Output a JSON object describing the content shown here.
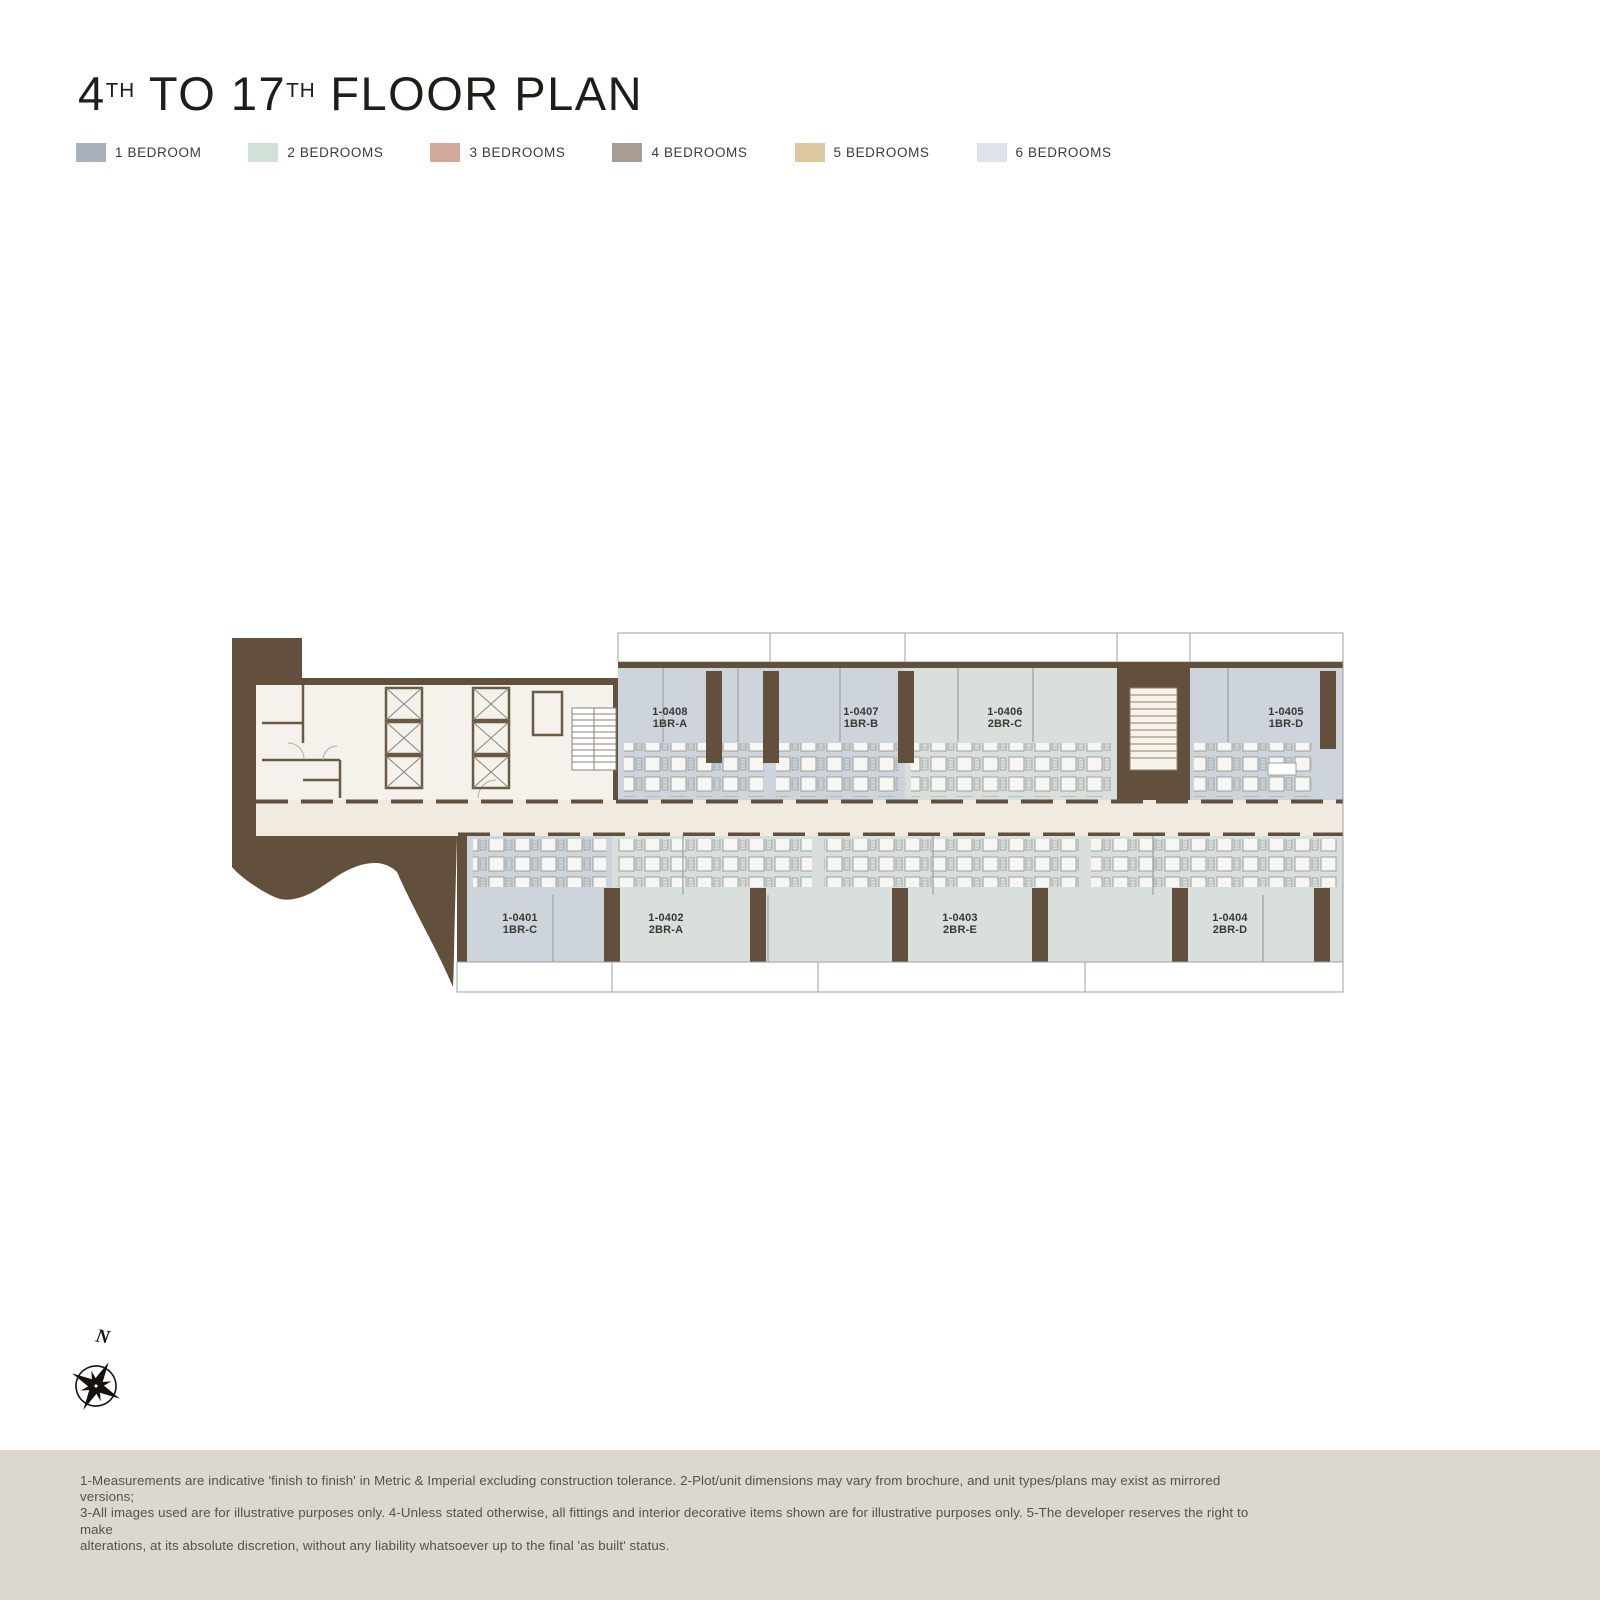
{
  "title": {
    "p1": "4",
    "s1": "TH",
    "p2": " TO 17",
    "s2": "TH",
    "p3": " FLOOR PLAN"
  },
  "legend": {
    "items": [
      {
        "label": "1 BEDROOM",
        "color": "#a9b1bd"
      },
      {
        "label": "2 BEDROOMS",
        "color": "#d2e1d8"
      },
      {
        "label": "3 BEDROOMS",
        "color": "#d2a89a"
      },
      {
        "label": "4 BEDROOMS",
        "color": "#a99c93"
      },
      {
        "label": "5 BEDROOMS",
        "color": "#ddc8a0"
      },
      {
        "label": "6 BEDROOMS",
        "color": "#dfe3e9"
      }
    ]
  },
  "plan": {
    "units": [
      {
        "id": "1-0408",
        "type": "1BR-A"
      },
      {
        "id": "1-0407",
        "type": "1BR-B"
      },
      {
        "id": "1-0406",
        "type": "2BR-C"
      },
      {
        "id": "1-0405",
        "type": "1BR-D"
      },
      {
        "id": "1-0401",
        "type": "1BR-C"
      },
      {
        "id": "1-0402",
        "type": "2BR-A"
      },
      {
        "id": "1-0403",
        "type": "2BR-E"
      },
      {
        "id": "1-0404",
        "type": "2BR-D"
      }
    ],
    "colors": {
      "wall": "#63503c",
      "one_br": "#cdd4dc",
      "two_br": "#d9e0db",
      "balcony": "#d7dbde",
      "corridor": "#f0eae1",
      "core": "#f5f2ec"
    }
  },
  "compass": {
    "north_label": "N"
  },
  "footer": {
    "lines": [
      "1-Measurements are indicative 'finish to finish' in Metric & Imperial excluding construction tolerance. 2-Plot/unit dimensions may vary from brochure, and unit types/plans may exist as mirrored versions;",
      "3-All images used are for illustrative purposes only. 4-Unless stated otherwise, all fittings and interior decorative items shown are for illustrative purposes only. 5-The developer reserves the right to make",
      "alterations, at its absolute discretion, without any liability whatsoever up to the final 'as built' status."
    ]
  }
}
